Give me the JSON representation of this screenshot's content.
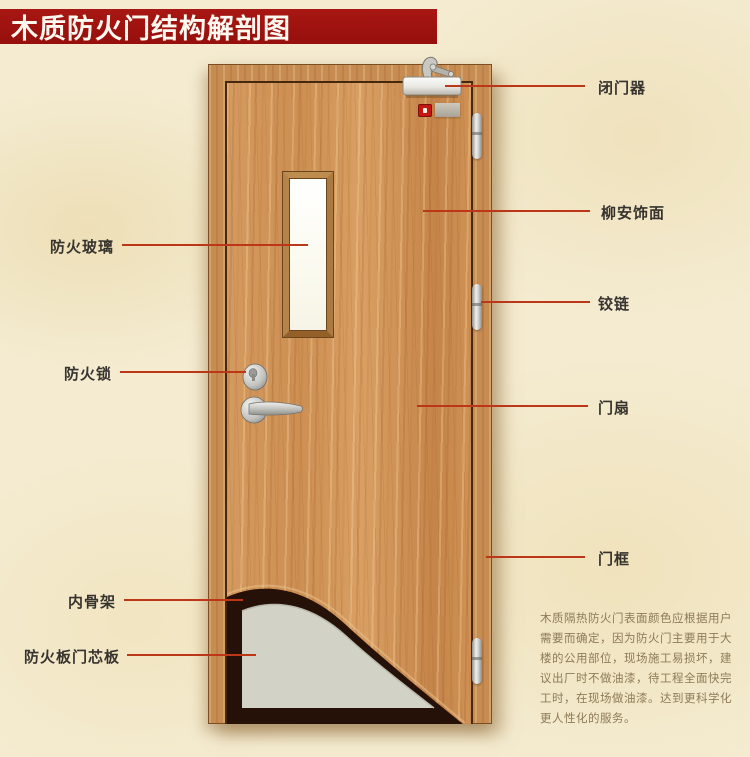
{
  "title": "木质防火门结构解剖图",
  "diagram": {
    "labels_left": [
      {
        "text": "防火玻璃"
      },
      {
        "text": "防火锁"
      },
      {
        "text": "内骨架"
      },
      {
        "text": "防火板门芯板"
      }
    ],
    "labels_right": [
      {
        "text": "闭门器"
      },
      {
        "text": "柳安饰面"
      },
      {
        "text": "铰链"
      },
      {
        "text": "门扇"
      },
      {
        "text": "门框"
      }
    ],
    "note_lines": [
      "木质隔热防火门表面颜色应根据用户",
      "需要而确定，因为防火门主要用于大",
      "楼的公用部位，现场施工易损坏，建",
      "议出厂时不做油漆，待工程全面快完",
      "工时，在现场做油漆。达到更科学化",
      "更人性化的服务。"
    ]
  },
  "colors": {
    "banner_red": "#9c1210",
    "leader_red": "#bb3718",
    "wood": "#cd8f52",
    "core_grey": "#d2d2c6",
    "skeleton_dark": "#261109",
    "paper": "#f4ebd0"
  }
}
